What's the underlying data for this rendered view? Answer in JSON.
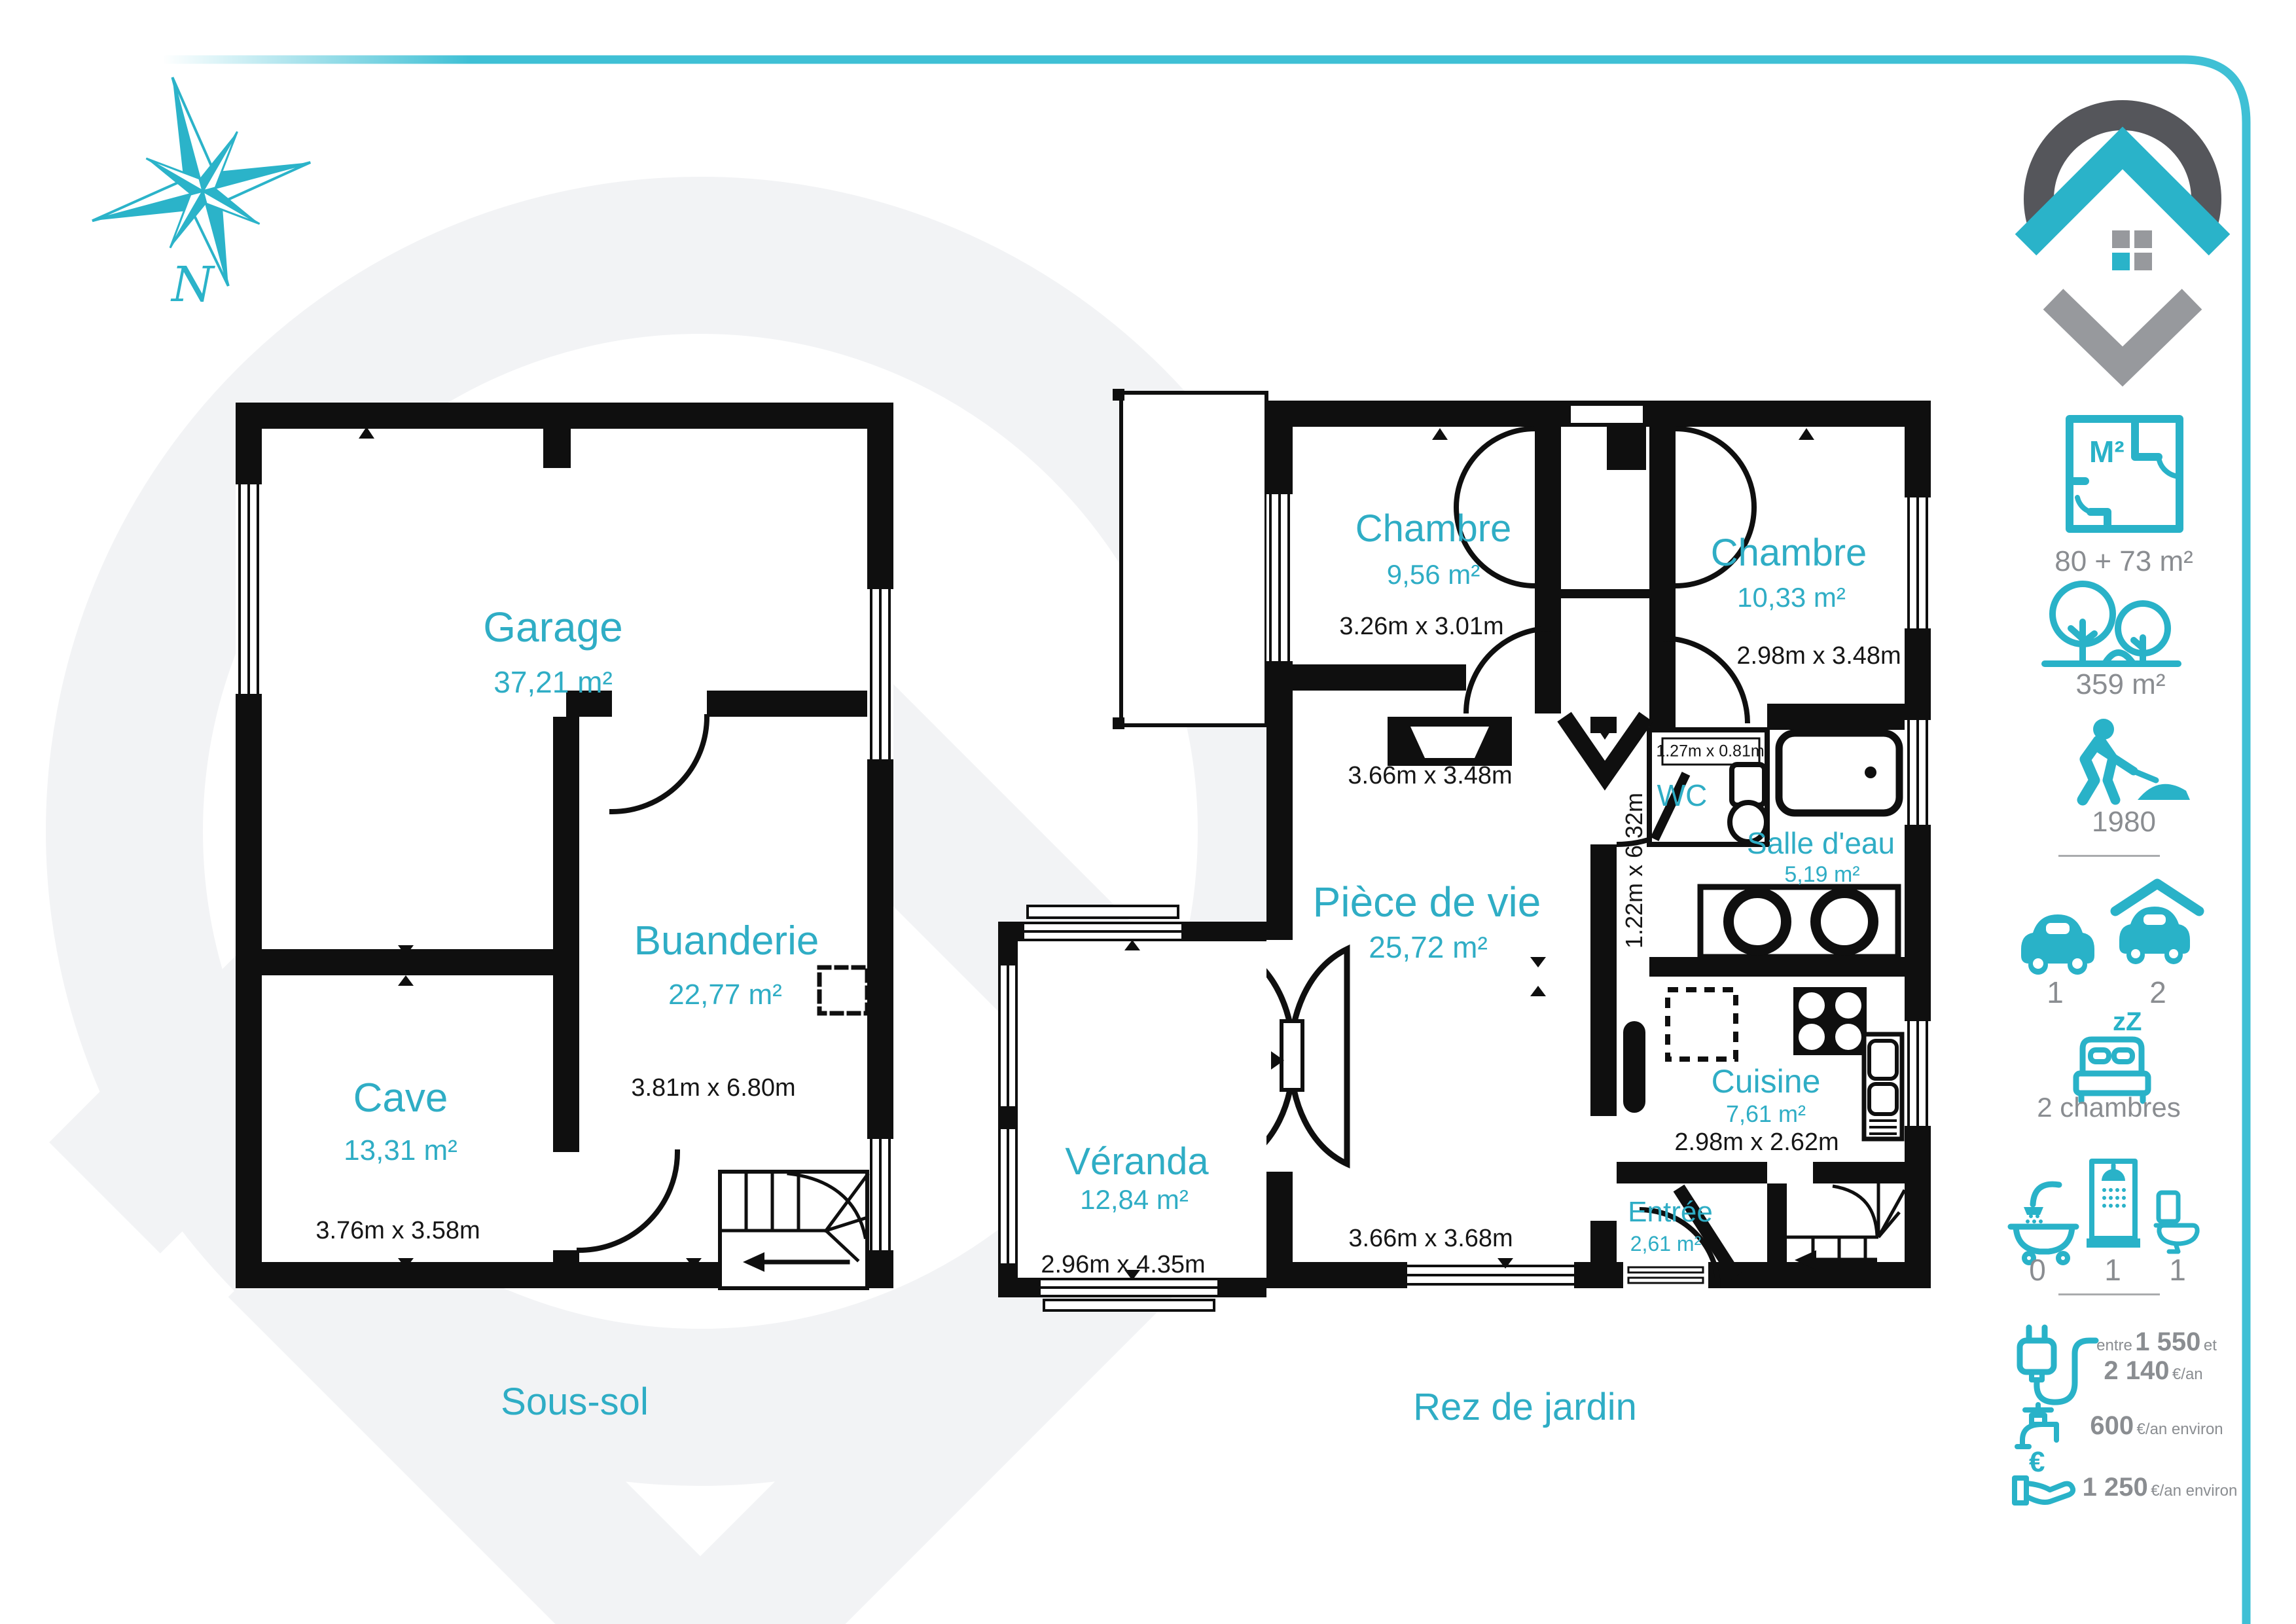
{
  "colors": {
    "teal": "#2fadc5",
    "icon_teal": "#29b2c8",
    "gray": "#8a8d91",
    "wall": "#0f0f0f"
  },
  "compass": {
    "label": "N"
  },
  "sous_sol": {
    "title": "Sous-sol",
    "garage": {
      "name": "Garage",
      "area": "37,21 m²"
    },
    "buanderie": {
      "name": "Buanderie",
      "area": "22,77 m²",
      "dim": "3.81m x 6.80m"
    },
    "cave": {
      "name": "Cave",
      "area": "13,31 m²",
      "dim": "3.76m x 3.58m"
    }
  },
  "rez": {
    "title": "Rez de jardin",
    "chambre1": {
      "name": "Chambre",
      "area": "9,56 m²",
      "dim": "3.26m x 3.01m"
    },
    "chambre2": {
      "name": "Chambre",
      "area": "10,33 m²",
      "dim": "2.98m x 3.48m"
    },
    "wc": {
      "name": "WC",
      "dim": "1.27m x 0.81m"
    },
    "salle_deau": {
      "name": "Salle d'eau",
      "area": "5,19 m²"
    },
    "piece_de_vie": {
      "name": "Pièce de vie",
      "area": "25,72 m²",
      "dim_top": "3.66m x 3.48m",
      "dim_bottom": "3.66m x 3.68m",
      "dim_hall": "1.22m x 6.32m"
    },
    "cuisine": {
      "name": "Cuisine",
      "area": "7,61 m²",
      "dim": "2.98m x 2.62m"
    },
    "veranda": {
      "name": "Véranda",
      "area": "12,84 m²",
      "dim": "2.96m x 4.35m"
    },
    "entree": {
      "name": "Entrée",
      "area": "2,61 m²"
    }
  },
  "sidebar": {
    "surface": {
      "icon_label": "M²",
      "value": "80 + 73 m²"
    },
    "land": {
      "value": "359 m²"
    },
    "year": {
      "value": "1980"
    },
    "parking": {
      "outdoor": "1",
      "garage": "2"
    },
    "bedrooms": {
      "icon_label": "zZ",
      "value": "2 chambres"
    },
    "bathrooms": {
      "bath": "0",
      "shower": "1",
      "wc": "1"
    },
    "energy": {
      "prefix": "entre",
      "low": "1 550",
      "conj": "et",
      "high": "2 140",
      "unit": "€/an"
    },
    "water": {
      "value": "600",
      "unit": "€/an environ"
    },
    "tax": {
      "icon_label": "€",
      "value": "1 250",
      "unit": "€/an environ"
    }
  }
}
